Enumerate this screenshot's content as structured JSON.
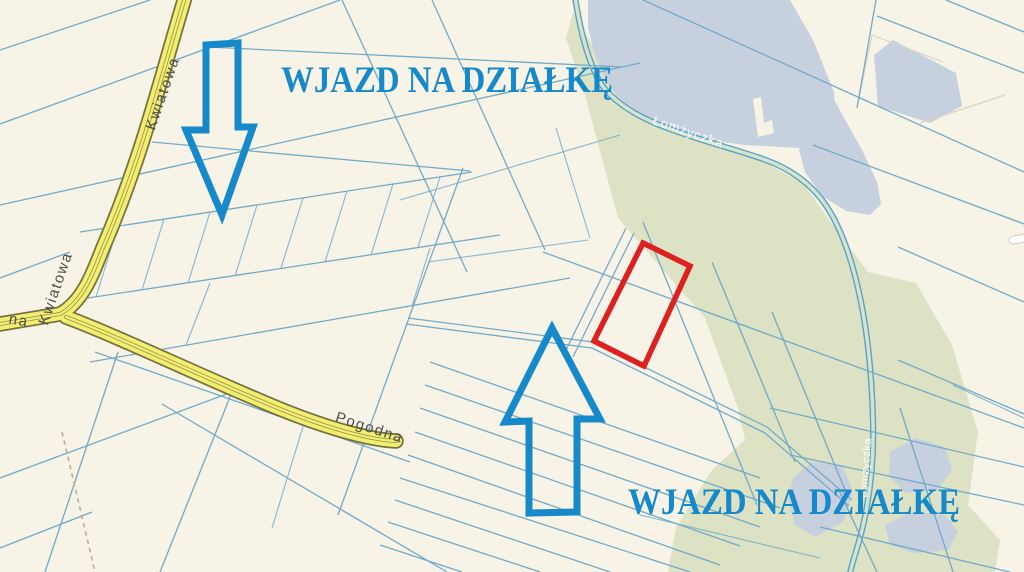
{
  "annotations": {
    "entrance_top": {
      "text": "WJAZD NA DZIAŁKĘ"
    },
    "entrance_bottom": {
      "text": "WJAZD NA DZIAŁKĘ"
    },
    "colors": {
      "arrow-blue": "#1589c9",
      "parcel-red": "#dd2020"
    }
  },
  "map": {
    "labels": {
      "street_kwiatowa_upper": "Kwiatowa",
      "street_kwiatowa_lower": "Kwiatowa",
      "street_pogodna": "Pogodna",
      "street_left_partial": "na",
      "stream_upper": "Łomżyczka",
      "stream_lower_vertical": "Łomżyczka"
    },
    "colors": {
      "background": "#f7f3e7",
      "parcel-line": "#72aac9",
      "faint-line": "#d9d5c5",
      "road-fill": "#f3ee72",
      "road-casing": "#73743e",
      "street-label": "#4e4e48",
      "water": "#c7d0df",
      "green": "#dce2c3",
      "stream": "#58a4c6",
      "stream-inner": "#d8e3cf",
      "dashed-path": "#b9ac9c",
      "stream-label": "#ffffff",
      "white-road": "#ffffff",
      "white-road-casing": "#cfcabc"
    }
  }
}
